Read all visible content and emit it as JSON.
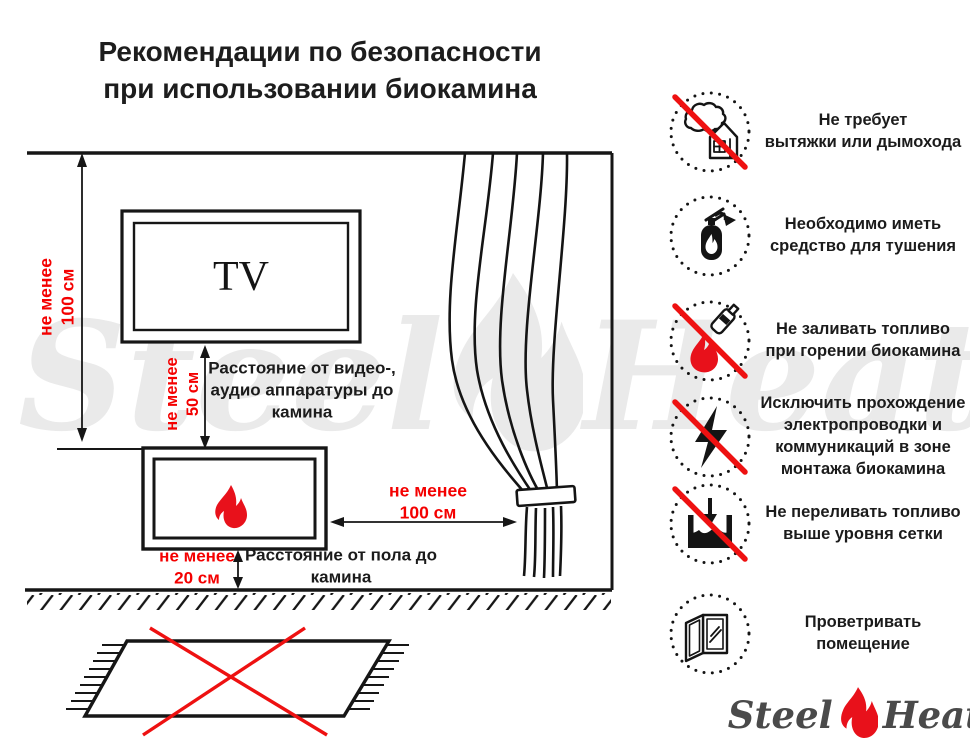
{
  "title": "Рекомендации по безопасности\nпри использовании биокамина",
  "diagram": {
    "tv_label": "TV",
    "wall_clearance": "не менее\n100 см",
    "tv_clearance": "не менее\n50 см",
    "tv_caption": "Расстояние от видео-,\nаудио аппаратуры до\nкамина",
    "curtain_clearance": "не менее\n100 см",
    "floor_clearance": "не менее\n20 см",
    "floor_caption": "Расстояние от пола до\nкамина"
  },
  "rules": [
    {
      "icon": "no-flue-icon",
      "crossed": true,
      "text": "Не требует\nвытяжки или дымохода"
    },
    {
      "icon": "extinguisher-icon",
      "crossed": false,
      "text": "Необходимо иметь\nсредство для тушения"
    },
    {
      "icon": "no-refuel-while-burning-icon",
      "crossed": true,
      "text": "Не заливать топливо\nпри горении биокамина"
    },
    {
      "icon": "no-wiring-in-mount-zone-icon",
      "crossed": true,
      "text": "Исключить прохождение\nэлектропроводки и\nкоммуникаций в зоне\nмонтажа биокамина"
    },
    {
      "icon": "no-overfill-icon",
      "crossed": true,
      "text": "Не переливать топливо\nвыше уровня сетки"
    },
    {
      "icon": "ventilate-room-icon",
      "crossed": false,
      "text": "Проветривать\nпомещение"
    }
  ],
  "logo": {
    "steel": "Steel",
    "heat": "Heat"
  },
  "watermark": {
    "steel": "Steel",
    "heat": "Heat"
  },
  "colors": {
    "accent_red": "#ee1111",
    "dimension_red": "#f40000",
    "ink": "#161616",
    "logo_gray": "#4a4a4a",
    "watermark_gray": "#eaeaea"
  }
}
